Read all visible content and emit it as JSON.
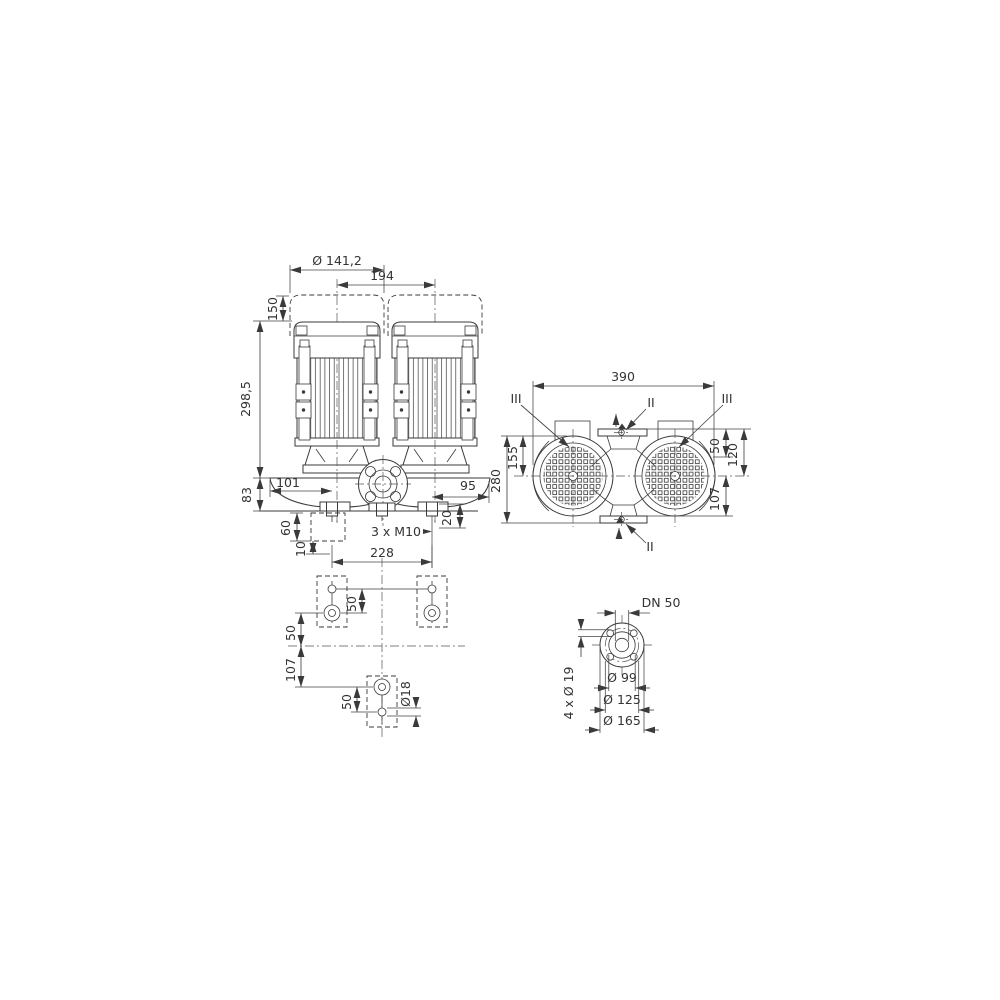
{
  "page": {
    "background": "#ffffff",
    "line_color": "#3a3a3a",
    "text_color": "#333333",
    "description": "Technical dimensional drawing of a twin inline pump, four views"
  },
  "views": {
    "front": {
      "motor_dia": "Ø 141,2",
      "motor_pitch": "194",
      "removal_clearance": "150",
      "overall_height": "298,5",
      "base_height": "83",
      "offset_left": "101",
      "offset_right": "95",
      "foot_height": "20",
      "block_depth": "60",
      "grout_depth": "10",
      "anchor_note": "3 x M10"
    },
    "plan": {
      "overall_width": "390",
      "overall_depth": "280",
      "top_to_center": "155",
      "dim_50": "50",
      "dim_120": "120",
      "dim_107": "107",
      "section_ii": "II",
      "section_iii": "III"
    },
    "foundation": {
      "bolt_pitch": "228",
      "pitch_50_top": "50",
      "offset_50": "50",
      "offset_107": "107",
      "pitch_50_bottom": "50",
      "hole_dia": "Ø18"
    },
    "flange": {
      "nominal": "DN 50",
      "bolt_holes": "4 x Ø 19",
      "raised_face_dia": "Ø 99",
      "bolt_circle_dia": "Ø 125",
      "outer_dia": "Ø 165"
    }
  }
}
